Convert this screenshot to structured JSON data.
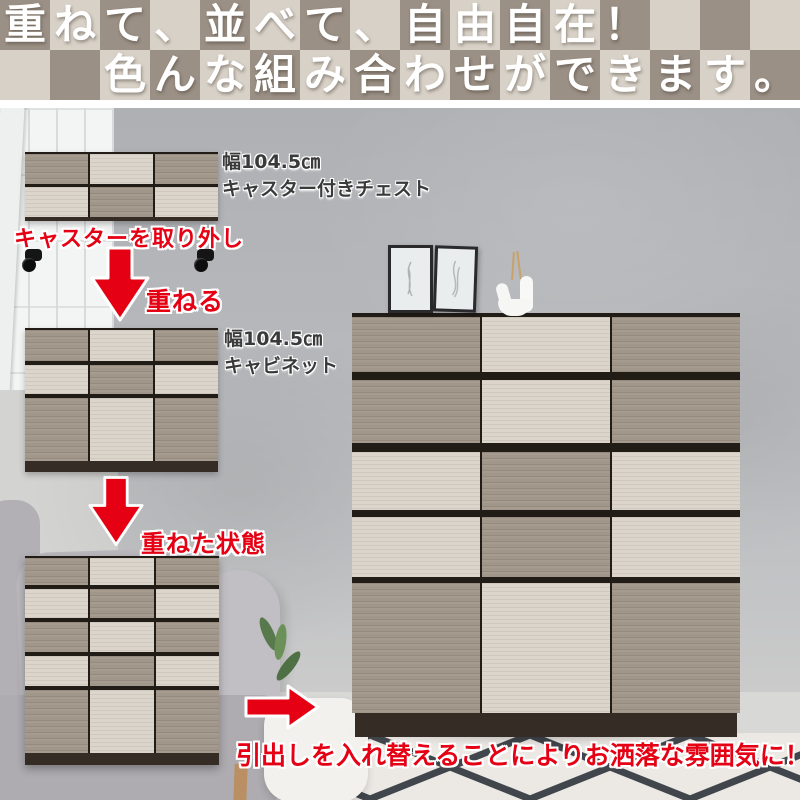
{
  "banner": {
    "line1": "重ねて、並べて、自由自在！",
    "line1_offset": 0,
    "line2": "色んな組み合わせができます。",
    "line2_offset": 2,
    "taupe": "#9b9085",
    "beige": "#d8d1c7",
    "text_color": "#ffffff"
  },
  "products": {
    "chest": {
      "size": "幅104.5㎝",
      "name": "キャスター付きチェスト"
    },
    "cabinet": {
      "size": "幅104.5㎝",
      "name": "キャビネット"
    }
  },
  "steps": {
    "remove_casters": "キャスターを取り外し",
    "stack": "重ねる",
    "stacked_state": "重ねた状態",
    "result": "引出しを入れ替えることによりお洒落な雰囲気に！"
  },
  "colors": {
    "accent_red": "#e50013",
    "wood_taupe": "#a09689",
    "wood_beige": "#dbd5cb",
    "wood_frame": "#221c16",
    "wood_base": "#352d25"
  },
  "furniture": {
    "chest_top": {
      "rows": [
        [
          "taupe",
          "beige",
          "taupe"
        ],
        [
          "beige",
          "taupe",
          "beige"
        ]
      ]
    },
    "cabinet": {
      "rows": [
        [
          "taupe",
          "beige",
          "taupe"
        ],
        [
          "beige",
          "taupe",
          "beige"
        ],
        [
          "taupe",
          "beige",
          "taupe"
        ]
      ]
    },
    "stacked": {
      "rows": [
        [
          "taupe",
          "beige",
          "taupe"
        ],
        [
          "beige",
          "taupe",
          "beige"
        ],
        [
          "taupe",
          "beige",
          "taupe"
        ],
        [
          "beige",
          "taupe",
          "beige"
        ],
        [
          "taupe",
          "beige",
          "taupe"
        ]
      ]
    },
    "large": {
      "rows": [
        [
          "taupe",
          "beige",
          "taupe"
        ],
        [
          "taupe",
          "beige",
          "taupe"
        ],
        [
          "beige",
          "taupe",
          "beige"
        ],
        [
          "beige",
          "taupe",
          "beige"
        ],
        [
          "taupe",
          "beige",
          "taupe"
        ]
      ]
    }
  }
}
